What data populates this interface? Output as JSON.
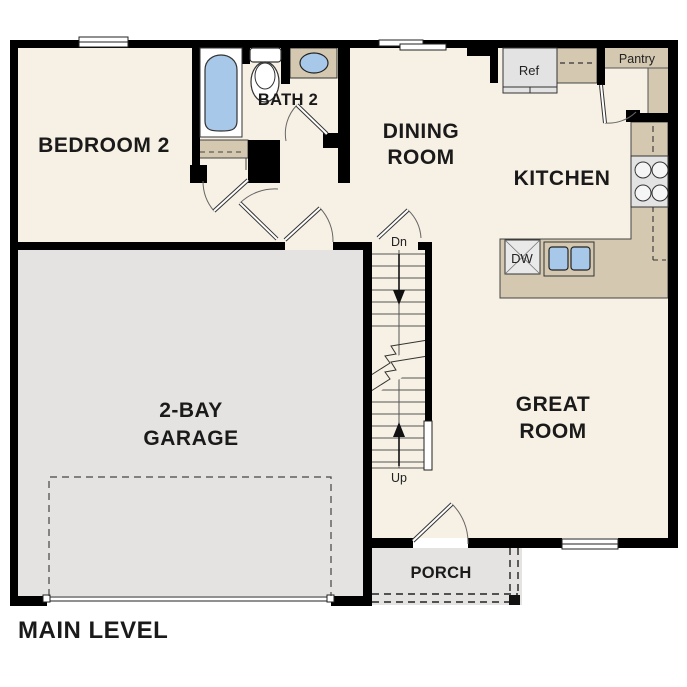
{
  "title": "MAIN LEVEL",
  "rooms": {
    "bedroom2": {
      "label": "BEDROOM 2"
    },
    "bath2": {
      "label": "BATH 2"
    },
    "dining": {
      "line1": "DINING",
      "line2": "ROOM"
    },
    "kitchen": {
      "label": "KITCHEN"
    },
    "great_room": {
      "line1": "GREAT",
      "line2": "ROOM"
    },
    "garage": {
      "line1": "2-BAY",
      "line2": "GARAGE"
    },
    "porch": {
      "label": "PORCH"
    },
    "pantry": {
      "label": "Pantry"
    }
  },
  "fixtures": {
    "refrigerator": "Ref",
    "dishwasher": "DW"
  },
  "stairs": {
    "down_label": "Dn",
    "up_label": "Up"
  },
  "colors": {
    "wall": "#000000",
    "floor_cream": "#f7f0e4",
    "garage_floor": "#e4e3e1",
    "porch_floor": "#e4e3e1",
    "cabinet_tan": "#d5c8b1",
    "fixture_blue": "#a8c8e9",
    "appliance_gray": "#e3e3e3",
    "thin_line": "#333333"
  }
}
